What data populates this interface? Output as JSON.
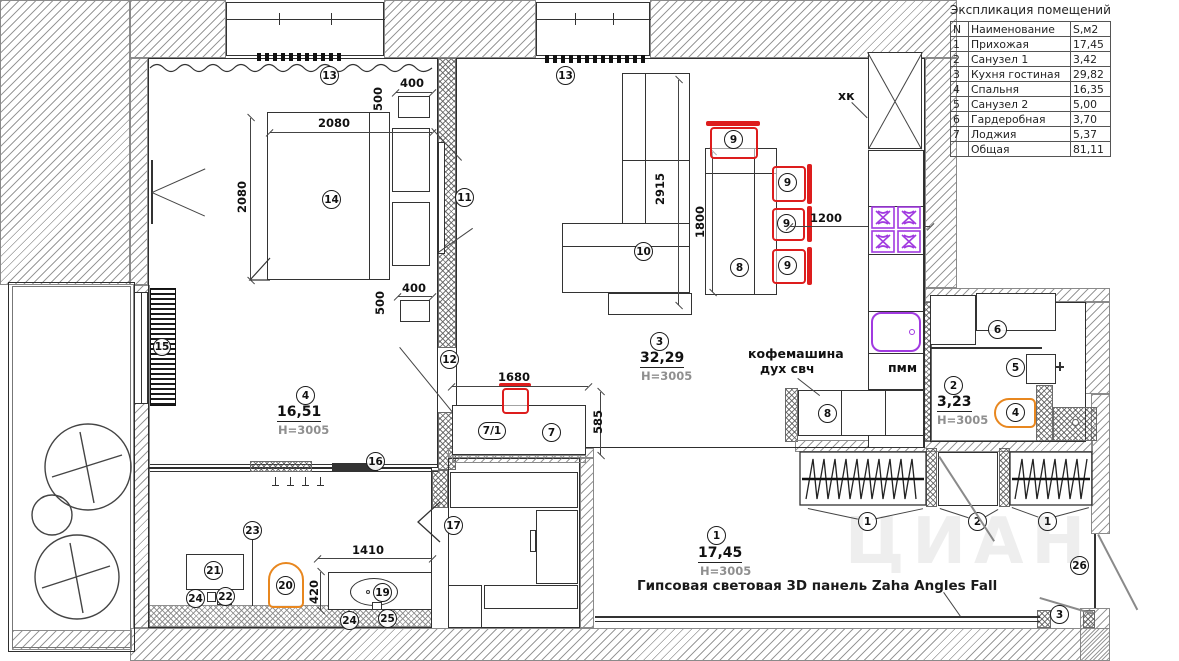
{
  "legend": {
    "title": "Экспликация помещений",
    "columns": {
      "num": "N",
      "name": "Наименование",
      "area": "S,м2"
    },
    "rows": [
      {
        "num": "1",
        "name": "Прихожая",
        "area": "17,45"
      },
      {
        "num": "2",
        "name": "Санузел 1",
        "area": "3,42"
      },
      {
        "num": "3",
        "name": "Кухня гостиная",
        "area": "29,82"
      },
      {
        "num": "4",
        "name": "Спальня",
        "area": "16,35"
      },
      {
        "num": "5",
        "name": "Санузел 2",
        "area": "5,00"
      },
      {
        "num": "6",
        "name": "Гардеробная",
        "area": "3,70"
      },
      {
        "num": "7",
        "name": "Лоджия",
        "area": "5,37"
      }
    ],
    "total": {
      "name": "Общая",
      "area": "81,11"
    }
  },
  "rooms": {
    "hall": {
      "num": "1",
      "area": "17,45",
      "height": "H=3005"
    },
    "bath1": {
      "num": "2",
      "area": "3,23",
      "height": "H=3005"
    },
    "kitchen": {
      "num": "3",
      "area": "32,29",
      "height": "H=3005"
    },
    "bedroom": {
      "num": "4",
      "area": "16,51",
      "height": "H=3005"
    }
  },
  "dims": {
    "d2080": "2080",
    "d400": "400",
    "d500": "500",
    "d2915": "2915",
    "d1800": "1800",
    "d1200": "1200",
    "d1680": "1680",
    "d585": "585",
    "d1410": "1410",
    "d420": "420"
  },
  "markers": {
    "1": "1",
    "2": "2",
    "3": "3",
    "4": "4",
    "5": "5",
    "6": "6",
    "7": "7",
    "7_1": "7/1",
    "8": "8",
    "9": "9",
    "10": "10",
    "11": "11",
    "12": "12",
    "13": "13",
    "14": "14",
    "15": "15",
    "16": "16",
    "17": "17",
    "18": "18",
    "19": "19",
    "20": "20",
    "21": "21",
    "22": "22",
    "23": "23",
    "24": "24",
    "25": "25",
    "26": "26"
  },
  "texts": {
    "fridge": "хк",
    "dishwasher": "пмм",
    "coffee_line1": "кофемашина",
    "coffee_line2": "дух свч",
    "panel_note": "Гипсовая световая 3D панель Zaha Angles Fall",
    "watermark": "ЦИАН"
  },
  "colors": {
    "chair_red": "#dd1d1d",
    "toilet_orange": "#e8871f",
    "plumbing_purple": "#a13ae0"
  }
}
